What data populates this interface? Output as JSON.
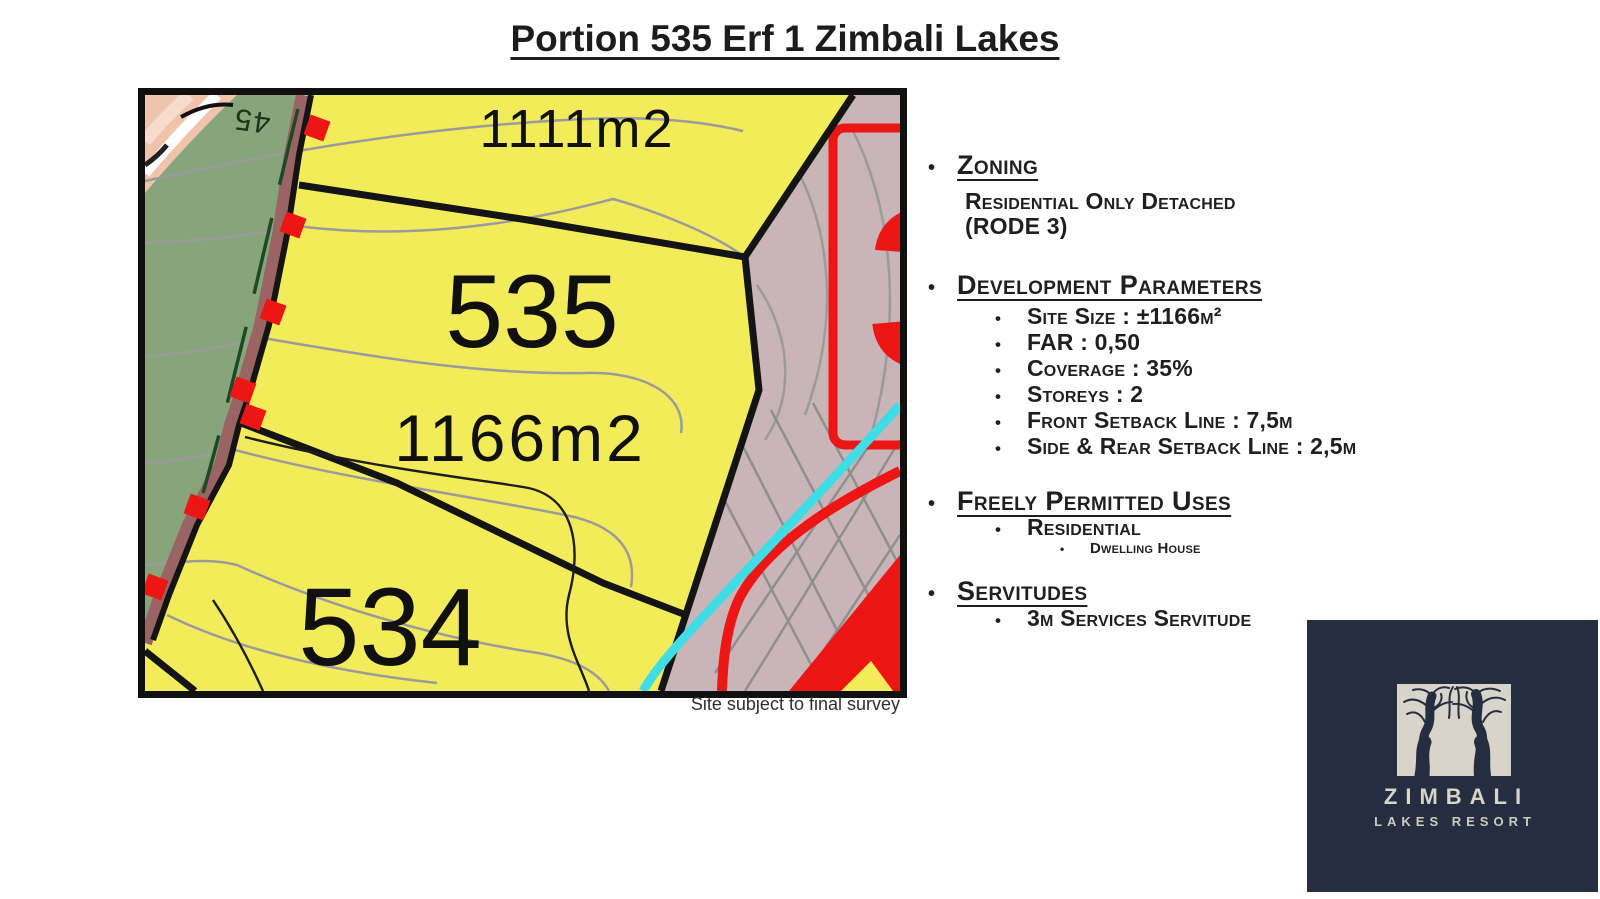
{
  "page": {
    "title": "Portion 535 Erf 1 Zimbali Lakes"
  },
  "map": {
    "caption": "Site subject to final survey",
    "labels": {
      "plot_top_area": "1111m2",
      "plot_main_number": "535",
      "plot_main_area": "1166m2",
      "plot_bottom_number": "534",
      "contour_elevation": "45",
      "adjacent_red_number": "3"
    },
    "colors": {
      "parcel_yellow": "#f3ec5a",
      "vegetation_green": "#86a57a",
      "adjacent_mauve": "#c9b4b8",
      "highlight_red": "#ee1515",
      "waterline_cyan": "#3fdde6",
      "road_strip_brown": "#9a6464"
    }
  },
  "info": {
    "sections": [
      {
        "heading": "Zoning",
        "lines": [
          "Residential Only Detached",
          "(RODE 3)"
        ]
      },
      {
        "heading": "Development Parameters",
        "items": [
          "Site Size : ±1166m²",
          "FAR : 0,50",
          "Coverage : 35%",
          "Storeys : 2",
          "Front Setback Line : 7,5m",
          "Side & Rear Setback Line : 2,5m"
        ]
      },
      {
        "heading": "Freely Permitted Uses",
        "items": [
          "Residential"
        ],
        "subitems": [
          "Dwelling House"
        ]
      },
      {
        "heading": "Servitudes",
        "items": [
          "3m Services Servitude"
        ]
      }
    ]
  },
  "logo": {
    "name": "ZIMBALI",
    "subtitle": "LAKES RESORT",
    "colors": {
      "background": "#242e40",
      "foreground": "#d9d4ca"
    }
  }
}
